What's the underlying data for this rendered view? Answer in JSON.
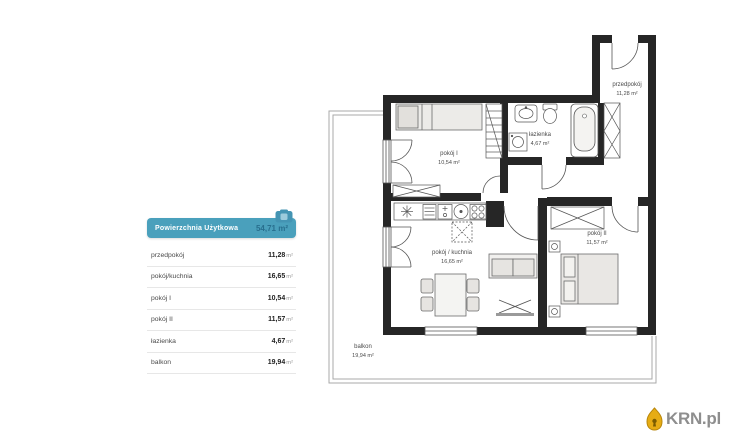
{
  "summary_table": {
    "header": {
      "label": "Powierzchnia Użytkowa",
      "value": "54,71 m²"
    },
    "rows": [
      {
        "label": "przedpokój",
        "value": "11,28",
        "unit": "m²"
      },
      {
        "label": "pokój/kuchnia",
        "value": "16,65",
        "unit": "m²"
      },
      {
        "label": "pokój I",
        "value": "10,54",
        "unit": "m²"
      },
      {
        "label": "pokój II",
        "value": "11,57",
        "unit": "m²"
      },
      {
        "label": "łazienka",
        "value": "4,67",
        "unit": "m²"
      },
      {
        "label": "balkon",
        "value": "19,94",
        "unit": "m²"
      }
    ]
  },
  "floor_plan": {
    "rooms": [
      {
        "name": "pokój I",
        "area": "10,54 m²"
      },
      {
        "name": "łazienka",
        "area": "4,67 m²"
      },
      {
        "name": "przedpokój",
        "area": "11,28 m²"
      },
      {
        "name": "pokój / kuchnia",
        "area": "16,65 m²"
      },
      {
        "name": "pokój II",
        "area": "11,57 m²"
      },
      {
        "name": "balkon",
        "area": "19,94 m²"
      }
    ]
  },
  "branding": {
    "logo_text": "KRN.pl"
  },
  "colors": {
    "header_bg": "#4AA0BC",
    "header_value": "#286F8E",
    "wall": "#262626",
    "balcony_line": "#A9A9A9",
    "logo_text": "#8E8E8E",
    "logo_icon": "#E6AC14"
  }
}
